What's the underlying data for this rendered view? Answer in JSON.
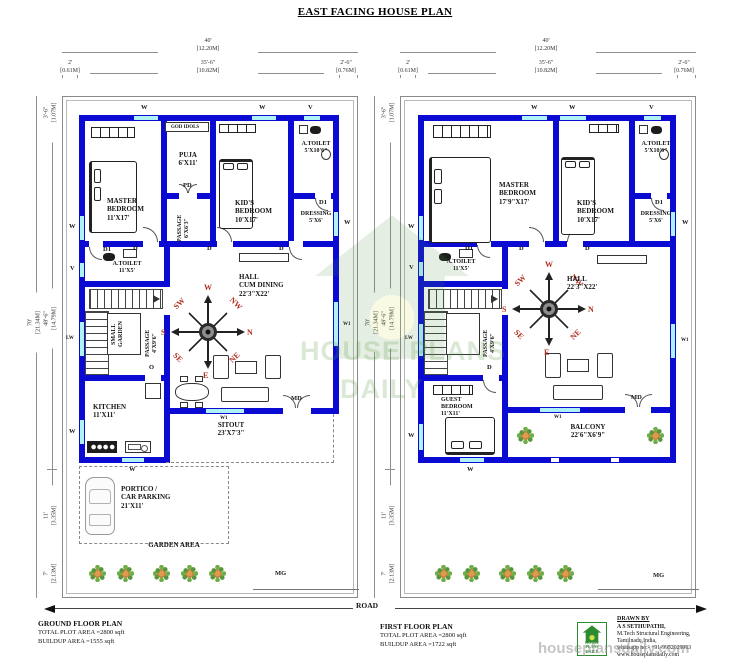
{
  "title": "EAST FACING HOUSE PLAN",
  "colors": {
    "wall": "#0a0ad2",
    "win": "#aef2f4",
    "compass": "#b03020",
    "logo_green": "#2e8b2e"
  },
  "dims": {
    "w_total": "40'\n[12.20M]",
    "w_left": "2'\n[0.61M]",
    "w_mid": "35'-6\"\n[10.82M]",
    "w_right": "2'-6\"\n[0.76M]",
    "h_total": "70'\n[21.34M]",
    "h_top": "3'-6\"\n[1.07M]",
    "h_main": "48'-6\"\n[14.79M]",
    "h_low": "11'\n[3.35M]",
    "h_bottom": "7'\n[2.13M]"
  },
  "labels": {
    "w": "W",
    "v": "V",
    "lw": "LW",
    "w1": "W1",
    "d": "D",
    "d1": "D1",
    "pd": "PD",
    "md": "MD",
    "o": "O",
    "mg": "MG",
    "god_idols": "GOD IDOLS"
  },
  "compass": {
    "n": "N",
    "s": "S",
    "e": "E",
    "w": "W",
    "ne": "NE",
    "nw": "NW",
    "se": "SE",
    "sw": "SW"
  },
  "ground": {
    "master": "MASTER\nBEDROOM\n11'X17'",
    "puja": "PUJA\n6'X11'",
    "kids": "KID'S\nBEDROOM\n10'X17'",
    "atoilet_top": "A.TOILET\n5'X10'6\"",
    "dressing": "DRESSING\n5'X6'",
    "passage_top": "PASSAGE\n6'X6'3\"",
    "atoilet_mid": "A.TOILET\n11'X5'",
    "small_garden": "SMALL\nGARDEN",
    "passage": "PASSAGE\n4'X9'6\"",
    "hall": "HALL\nCUM DINING\n22'3\"X22'",
    "kitchen": "KITCHEN\n11'X11'",
    "sitout": "SITOUT\n23'X7'3\"",
    "portico": "PORTICO /\nCAR PARKING\n21'X11'",
    "garden": "GARDEN AREA"
  },
  "first": {
    "master": "MASTER\nBEDROOM\n17'9\"X17'",
    "kids": "KID'S\nBEDROOM\n10'X17'",
    "atoilet_top": "A.TOILET\n5'X10'6\"",
    "dressing": "DRESSING\n5'X6'",
    "atoilet_mid": "A.TOILET\n11'X5'",
    "passage": "PASSAGE\n4'X9'6\"",
    "hall": "HALL\n22'3\"X22'",
    "guest": "GUEST\nBEDROOM\n11'X11'",
    "balcony": "BALCONY\n22'6\"X6'9\""
  },
  "footer": {
    "road": "ROAD",
    "ground_title": "GROUND FLOOR PLAN",
    "ground_line1": "TOTAL PLOT AREA =2800 sqft",
    "ground_line2": "BUILDUP AREA =1555 sqft",
    "first_title": "FIRST FLOOR PLAN",
    "first_line1": "TOTAL PLOT AREA =2800 sqft",
    "first_line2": "BUILDUP AREA =1722 sqft"
  },
  "credits": {
    "heading": "DRAWN BY",
    "name": "A S SETHUPATHI,",
    "line2": "M.Tech Structural Engineering,",
    "line3": "Tamilnadu,India,",
    "line4": "whatsapp no:- +91-9952029063",
    "line5": "www.houseplansdaily.com"
  },
  "logo": {
    "text": "HOUSE PLANS\nDAILY"
  },
  "watermark": {
    "center_line1": "HOUSE PLANS",
    "center_line2": "DAILY",
    "corner": "houseplansdaily.com"
  }
}
